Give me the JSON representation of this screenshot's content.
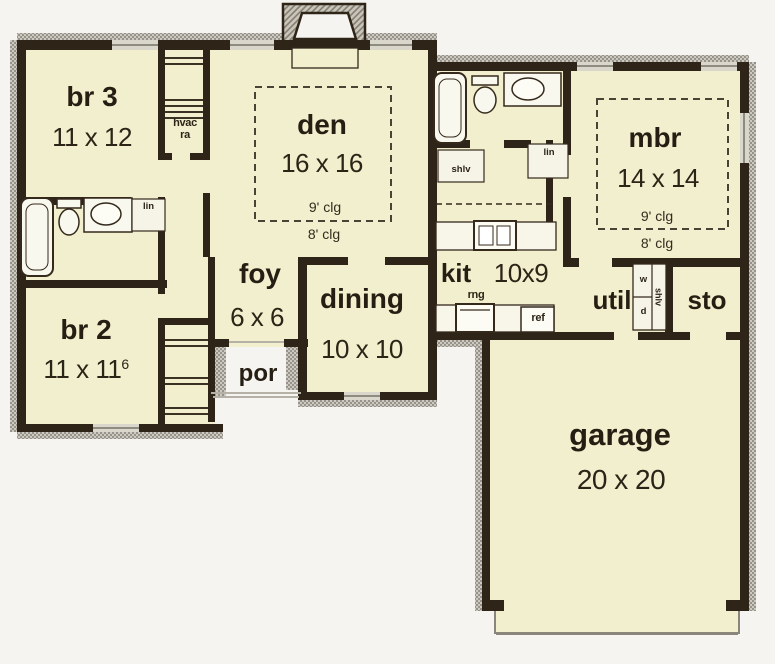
{
  "plan_title": "single-story house floor plan",
  "colors": {
    "background": "#f5f4f1",
    "floor": "#f1efcd",
    "wall": "#2e2518",
    "texture": "#a09c93",
    "text": "#261e13"
  },
  "rooms": {
    "br3": {
      "name": "br 3",
      "dims": "11 x 12"
    },
    "den": {
      "name": "den",
      "dims": "16 x 16",
      "clg9": "9' clg",
      "clg8": "8' clg"
    },
    "br2": {
      "name": "br 2",
      "dims": "11 x 11",
      "dims_sup": "6"
    },
    "foy": {
      "name": "foy",
      "dims": "6 x 6"
    },
    "por": {
      "name": "por"
    },
    "dining": {
      "name": "dining",
      "dims": "10 x 10"
    },
    "kit": {
      "name": "kit",
      "dims": "10x9"
    },
    "mbr": {
      "name": "mbr",
      "dims": "14 x 14",
      "clg9": "9' clg",
      "clg8": "8' clg"
    },
    "util": {
      "name": "util"
    },
    "sto": {
      "name": "sto"
    },
    "garage": {
      "name": "garage",
      "dims": "20 x 20"
    }
  },
  "fixtures": {
    "hvac_line1": "hvac",
    "hvac_line2": "ra",
    "lin_hall_bath": "lin",
    "lin_kitchen": "lin",
    "shlv_pantry": "shlv",
    "shlv_util": "shlv",
    "range": "rng",
    "refrigerator": "ref",
    "washer": "w",
    "dryer": "d"
  }
}
